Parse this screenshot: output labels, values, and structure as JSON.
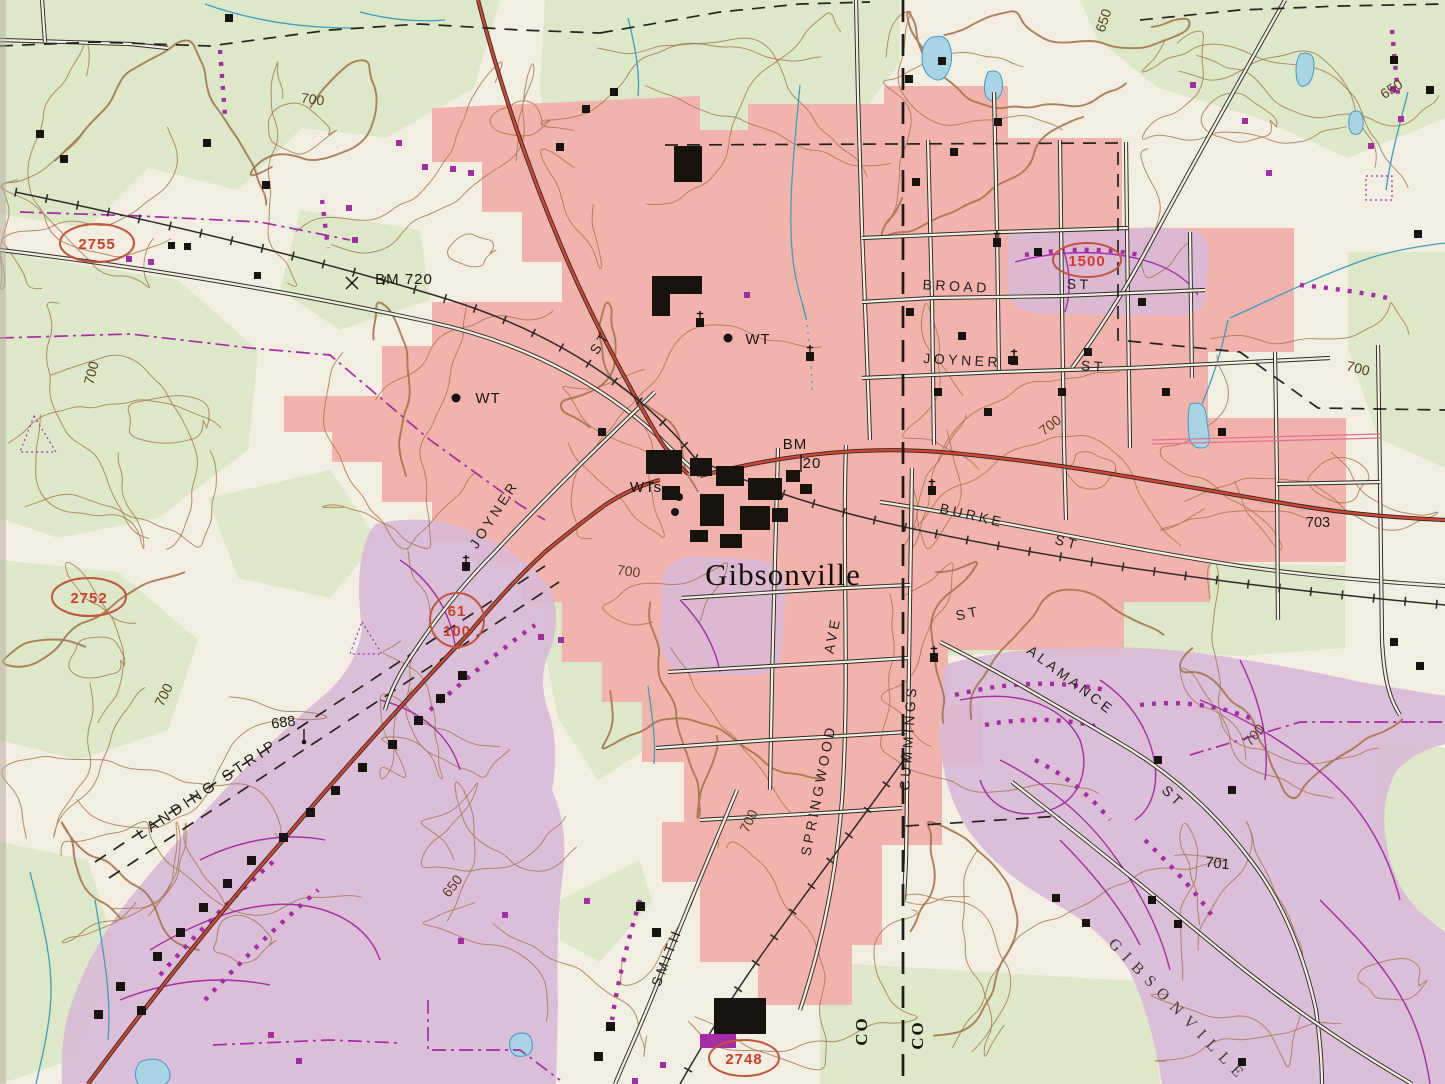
{
  "map": {
    "town": "Gibsonville",
    "labels": {
      "town": "Gibsonville",
      "broad": "BROAD",
      "joyner": "JOYNER",
      "burke": "BURKE",
      "springwood": "SPRINGWOOD",
      "ave": "AVE",
      "cummings": "CUMMINGS",
      "alamance": "ALAMANCE",
      "smith": "SMITH",
      "st": "ST",
      "landing_strip": "LANDING STRIP",
      "gibsonville_road": "GIBSONVILLE",
      "co": "CO",
      "bm_720": "BM 720",
      "bm": "BM",
      "bm_20": "20",
      "wt": "WT",
      "wts": "WTs",
      "e700": "700",
      "e650": "650",
      "e688": "688",
      "e703": "703",
      "e701": "701",
      "r2755": "2755",
      "r2752": "2752",
      "r1500": "1500",
      "r2748": "2748",
      "r61": "61",
      "r100": "100"
    },
    "colors": {
      "paper": "#f2eee2",
      "wood": "#dce8c8",
      "urban": "#f3b3ad",
      "rev": "#d9bad6",
      "wfill": "#a9d4e4",
      "wline": "#3f9cc3",
      "contour": "#a3744a",
      "road": "#2e2a26",
      "hwy": "#d2452f",
      "pp": "#a62ca6",
      "sred": "#cd3d28",
      "sstroke": "#c4553c",
      "ink": "#221f1b"
    }
  }
}
